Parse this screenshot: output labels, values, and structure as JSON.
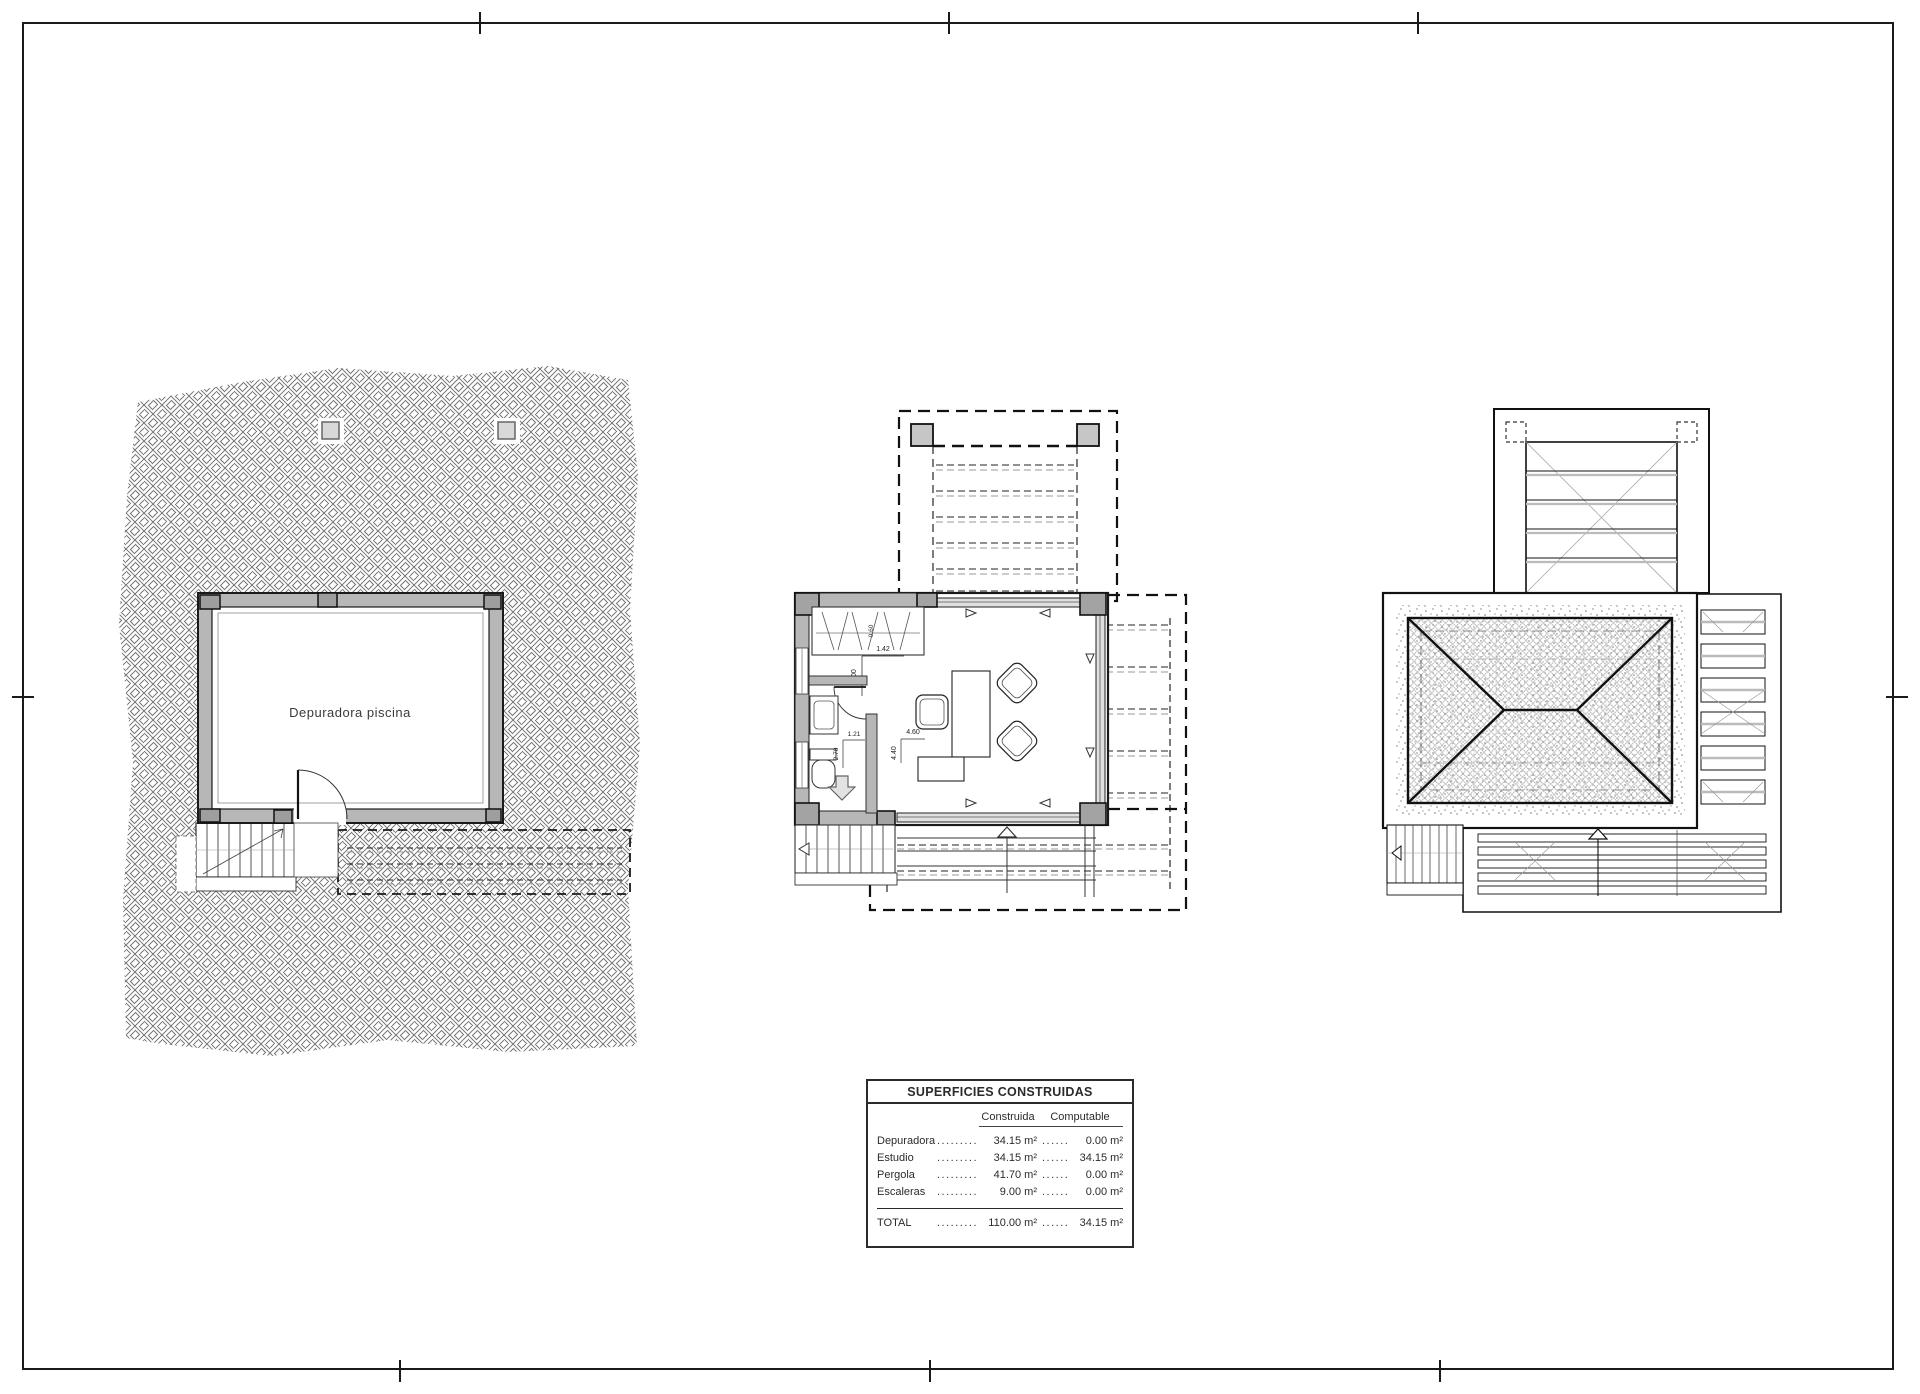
{
  "page": {
    "bg": "#ffffff",
    "line_color": "#1a1a1a",
    "wall_gray": "#b7b7b7",
    "column_gray": "#9e9e9e"
  },
  "plans": {
    "basement": {
      "room_label": "Depuradora piscina"
    },
    "studio": {
      "dims": {
        "closet_width": "1.42",
        "closet_height": "1.00",
        "wardrobe_depth": "0.60",
        "bath_width": "1.21",
        "bath_length": "2.70",
        "room_width": "4.60",
        "room_depth": "4.40"
      }
    }
  },
  "areas_table": {
    "title": "SUPERFICIES CONSTRUIDAS",
    "columns": {
      "construida": "Construida",
      "computable": "Computable"
    },
    "rows": [
      {
        "name": "Depuradora",
        "l1": "........................",
        "construida": "34.15 m²",
        "l2": "..............",
        "computable": "0.00 m²"
      },
      {
        "name": "Estudio",
        "l1": "........................",
        "construida": "34.15 m²",
        "l2": "..............",
        "computable": "34.15 m²"
      },
      {
        "name": "Pergola",
        "l1": "........................",
        "construida": "41.70 m²",
        "l2": "..............",
        "computable": "0.00 m²"
      },
      {
        "name": "Escaleras",
        "l1": "........................",
        "construida": "9.00 m²",
        "l2": "..............",
        "computable": "0.00 m²"
      }
    ],
    "total": {
      "name": "TOTAL",
      "l1": "........................",
      "construida": "110.00 m²",
      "l2": "..............",
      "computable": "34.15 m²"
    }
  }
}
